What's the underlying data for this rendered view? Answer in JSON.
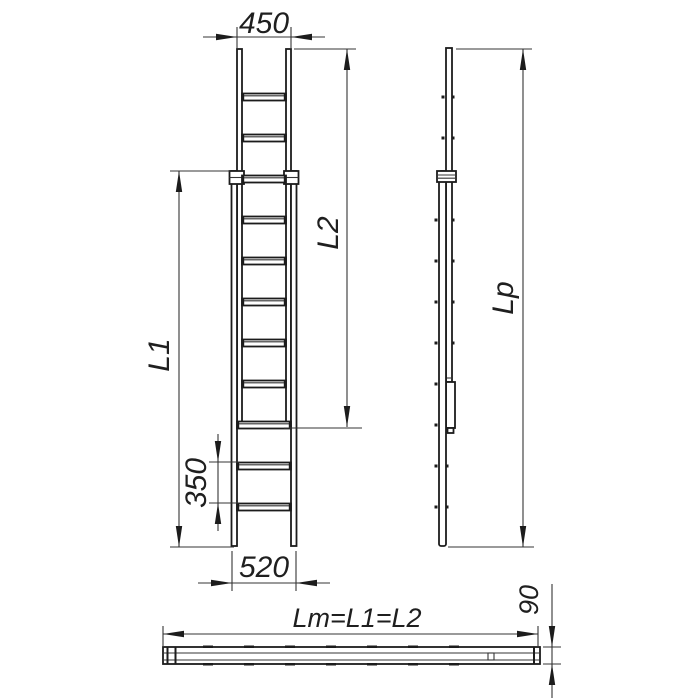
{
  "drawing": {
    "labels": {
      "top_width": "450",
      "upper_section_length": "L2",
      "lower_section_length": "L1",
      "rung_spacing": "350",
      "bottom_width": "520",
      "side_profile_length": "Lp",
      "plan_length_formula": "Lm=L1=L2",
      "profile_height": "90"
    },
    "line_color": "#1c1c1c",
    "background_color": "#ffffff"
  }
}
